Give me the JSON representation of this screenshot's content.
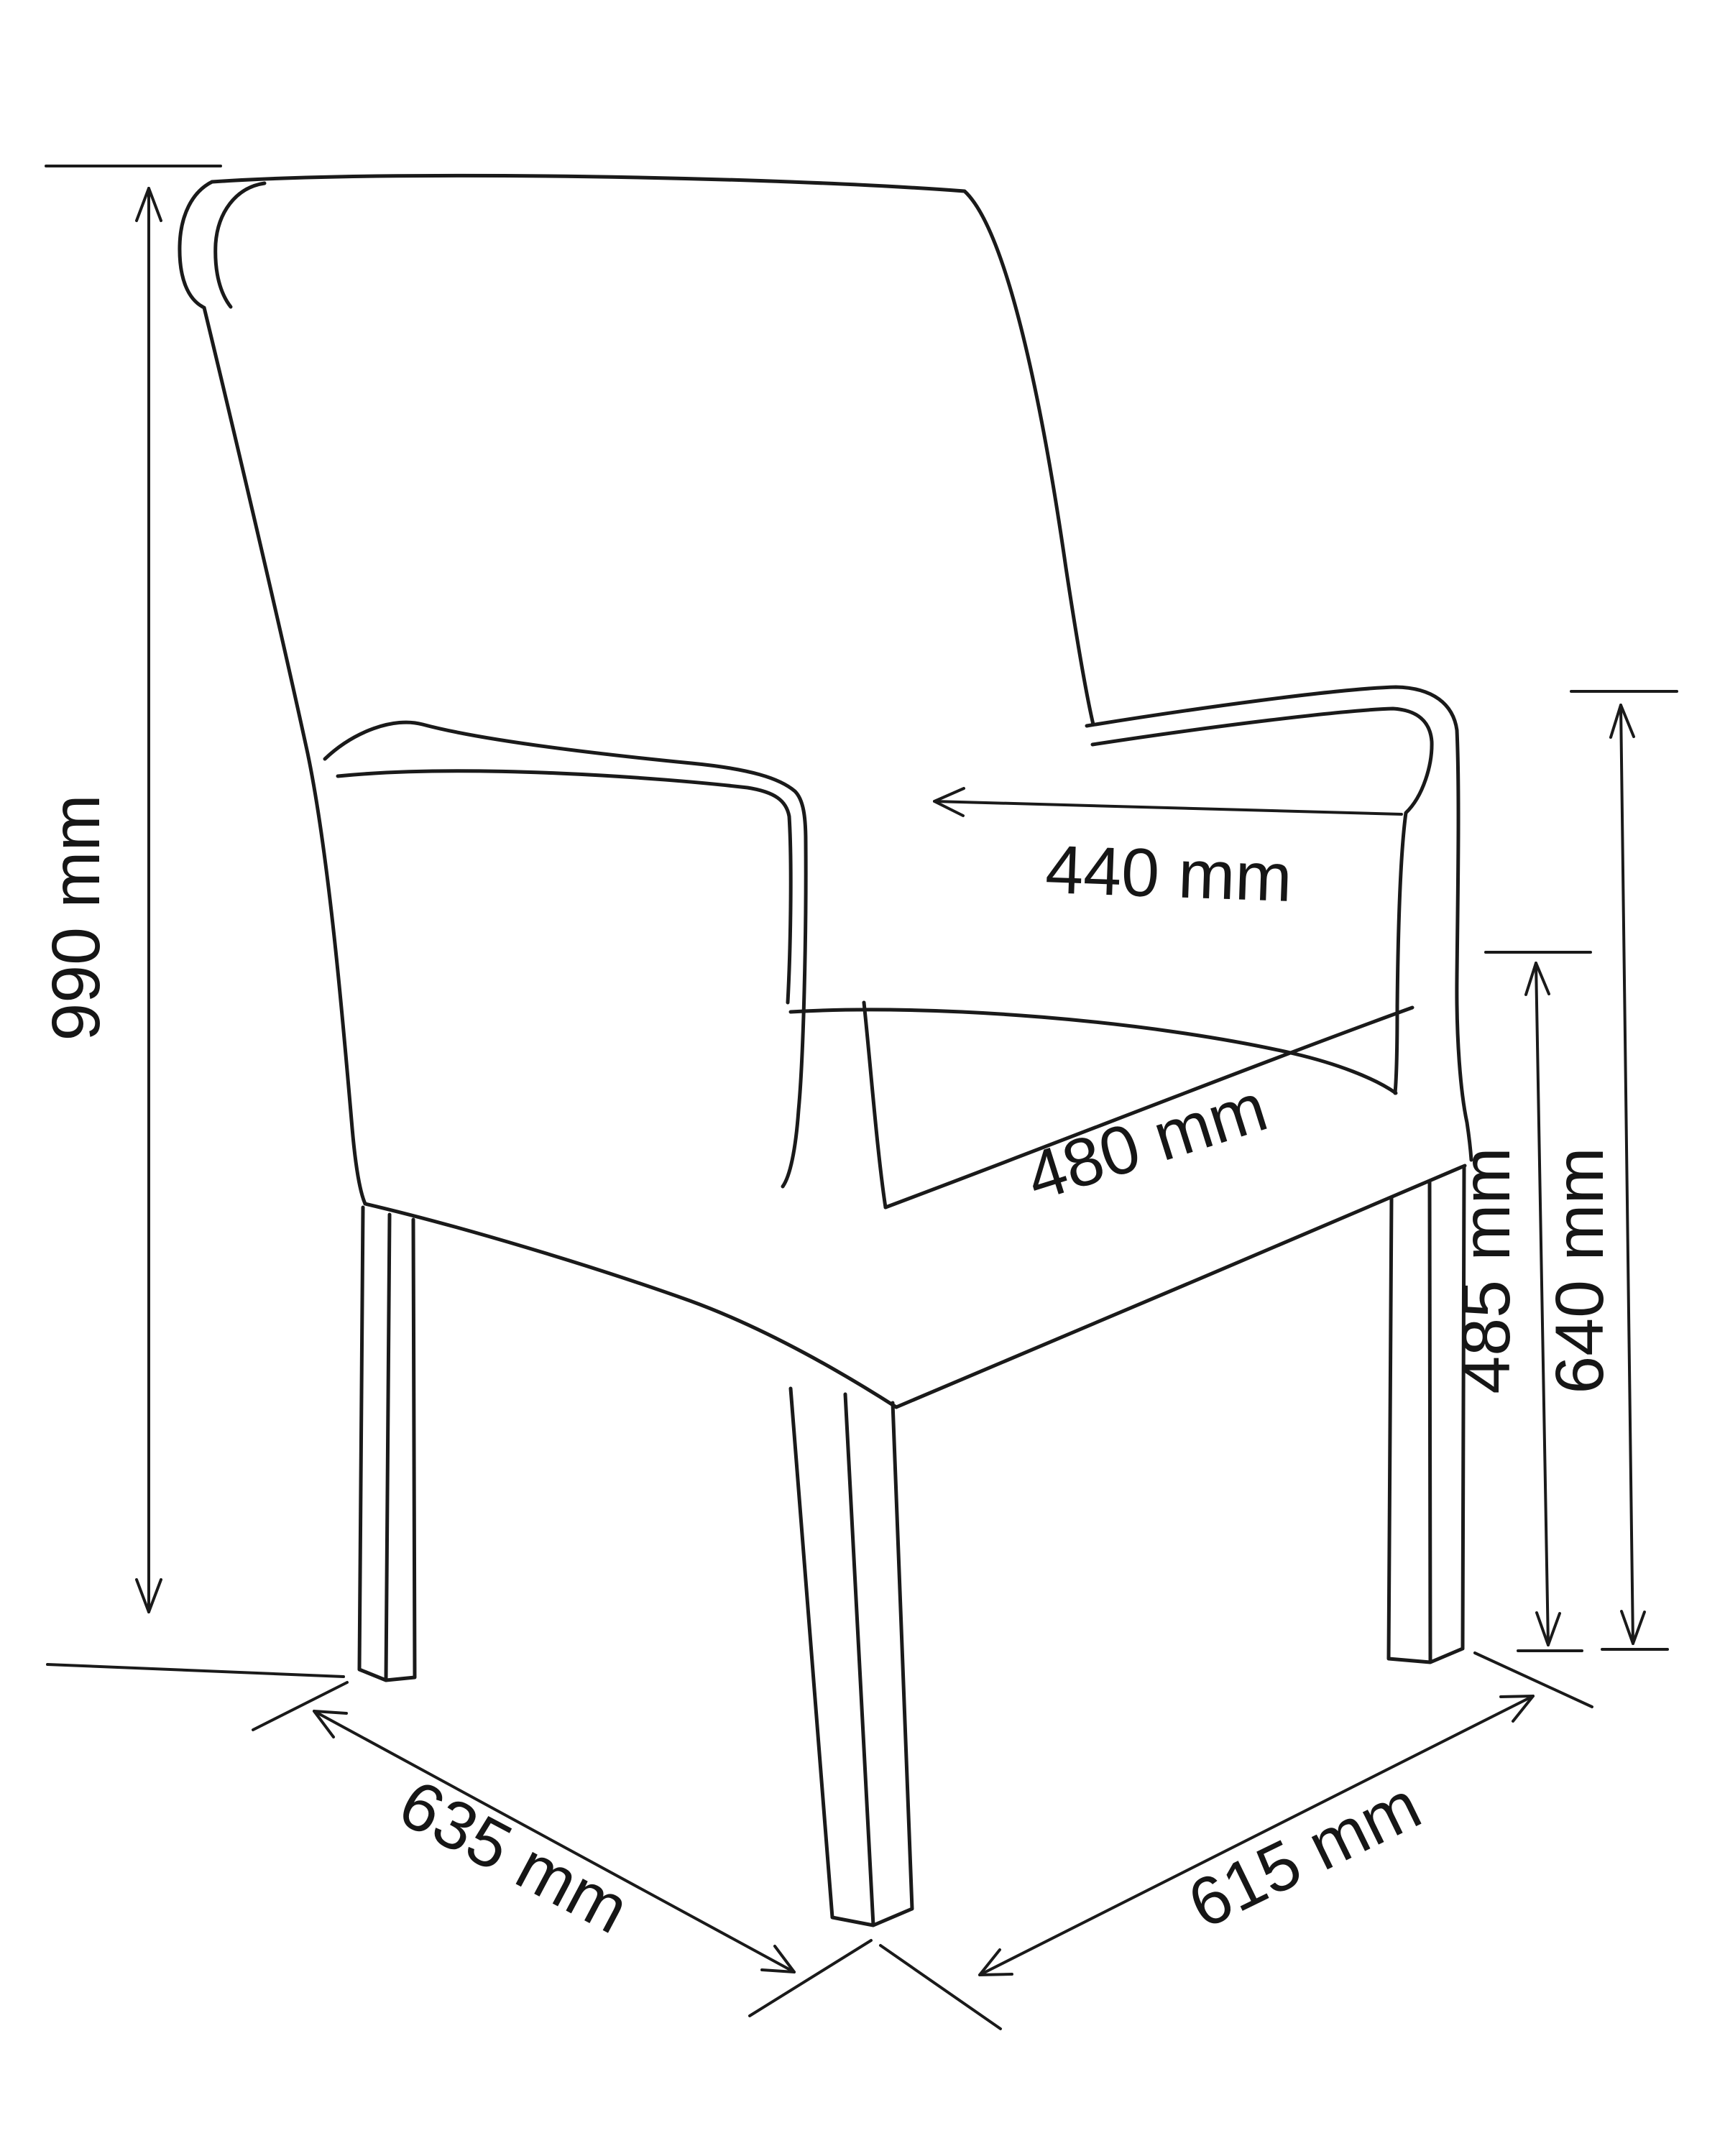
{
  "figure": {
    "type": "furniture-dimension-diagram",
    "subject": "Upholstered dining armchair, three-quarter view line drawing with dimension arrows",
    "unit": "mm",
    "colors": {
      "line": "#1a1a1a",
      "background": "#ffffff",
      "text": "#161616"
    },
    "dimensions": {
      "overall_height": {
        "label": "990 mm",
        "value": 990
      },
      "backrest_width": {
        "label": "440 mm",
        "value": 440
      },
      "seat_width": {
        "label": "480 mm",
        "value": 480
      },
      "seat_height": {
        "label": "485 mm",
        "value": 485
      },
      "armrest_height": {
        "label": "640 mm",
        "value": 640
      },
      "depth": {
        "label": "635 mm",
        "value": 635
      },
      "width": {
        "label": "615 mm",
        "value": 615
      }
    }
  }
}
